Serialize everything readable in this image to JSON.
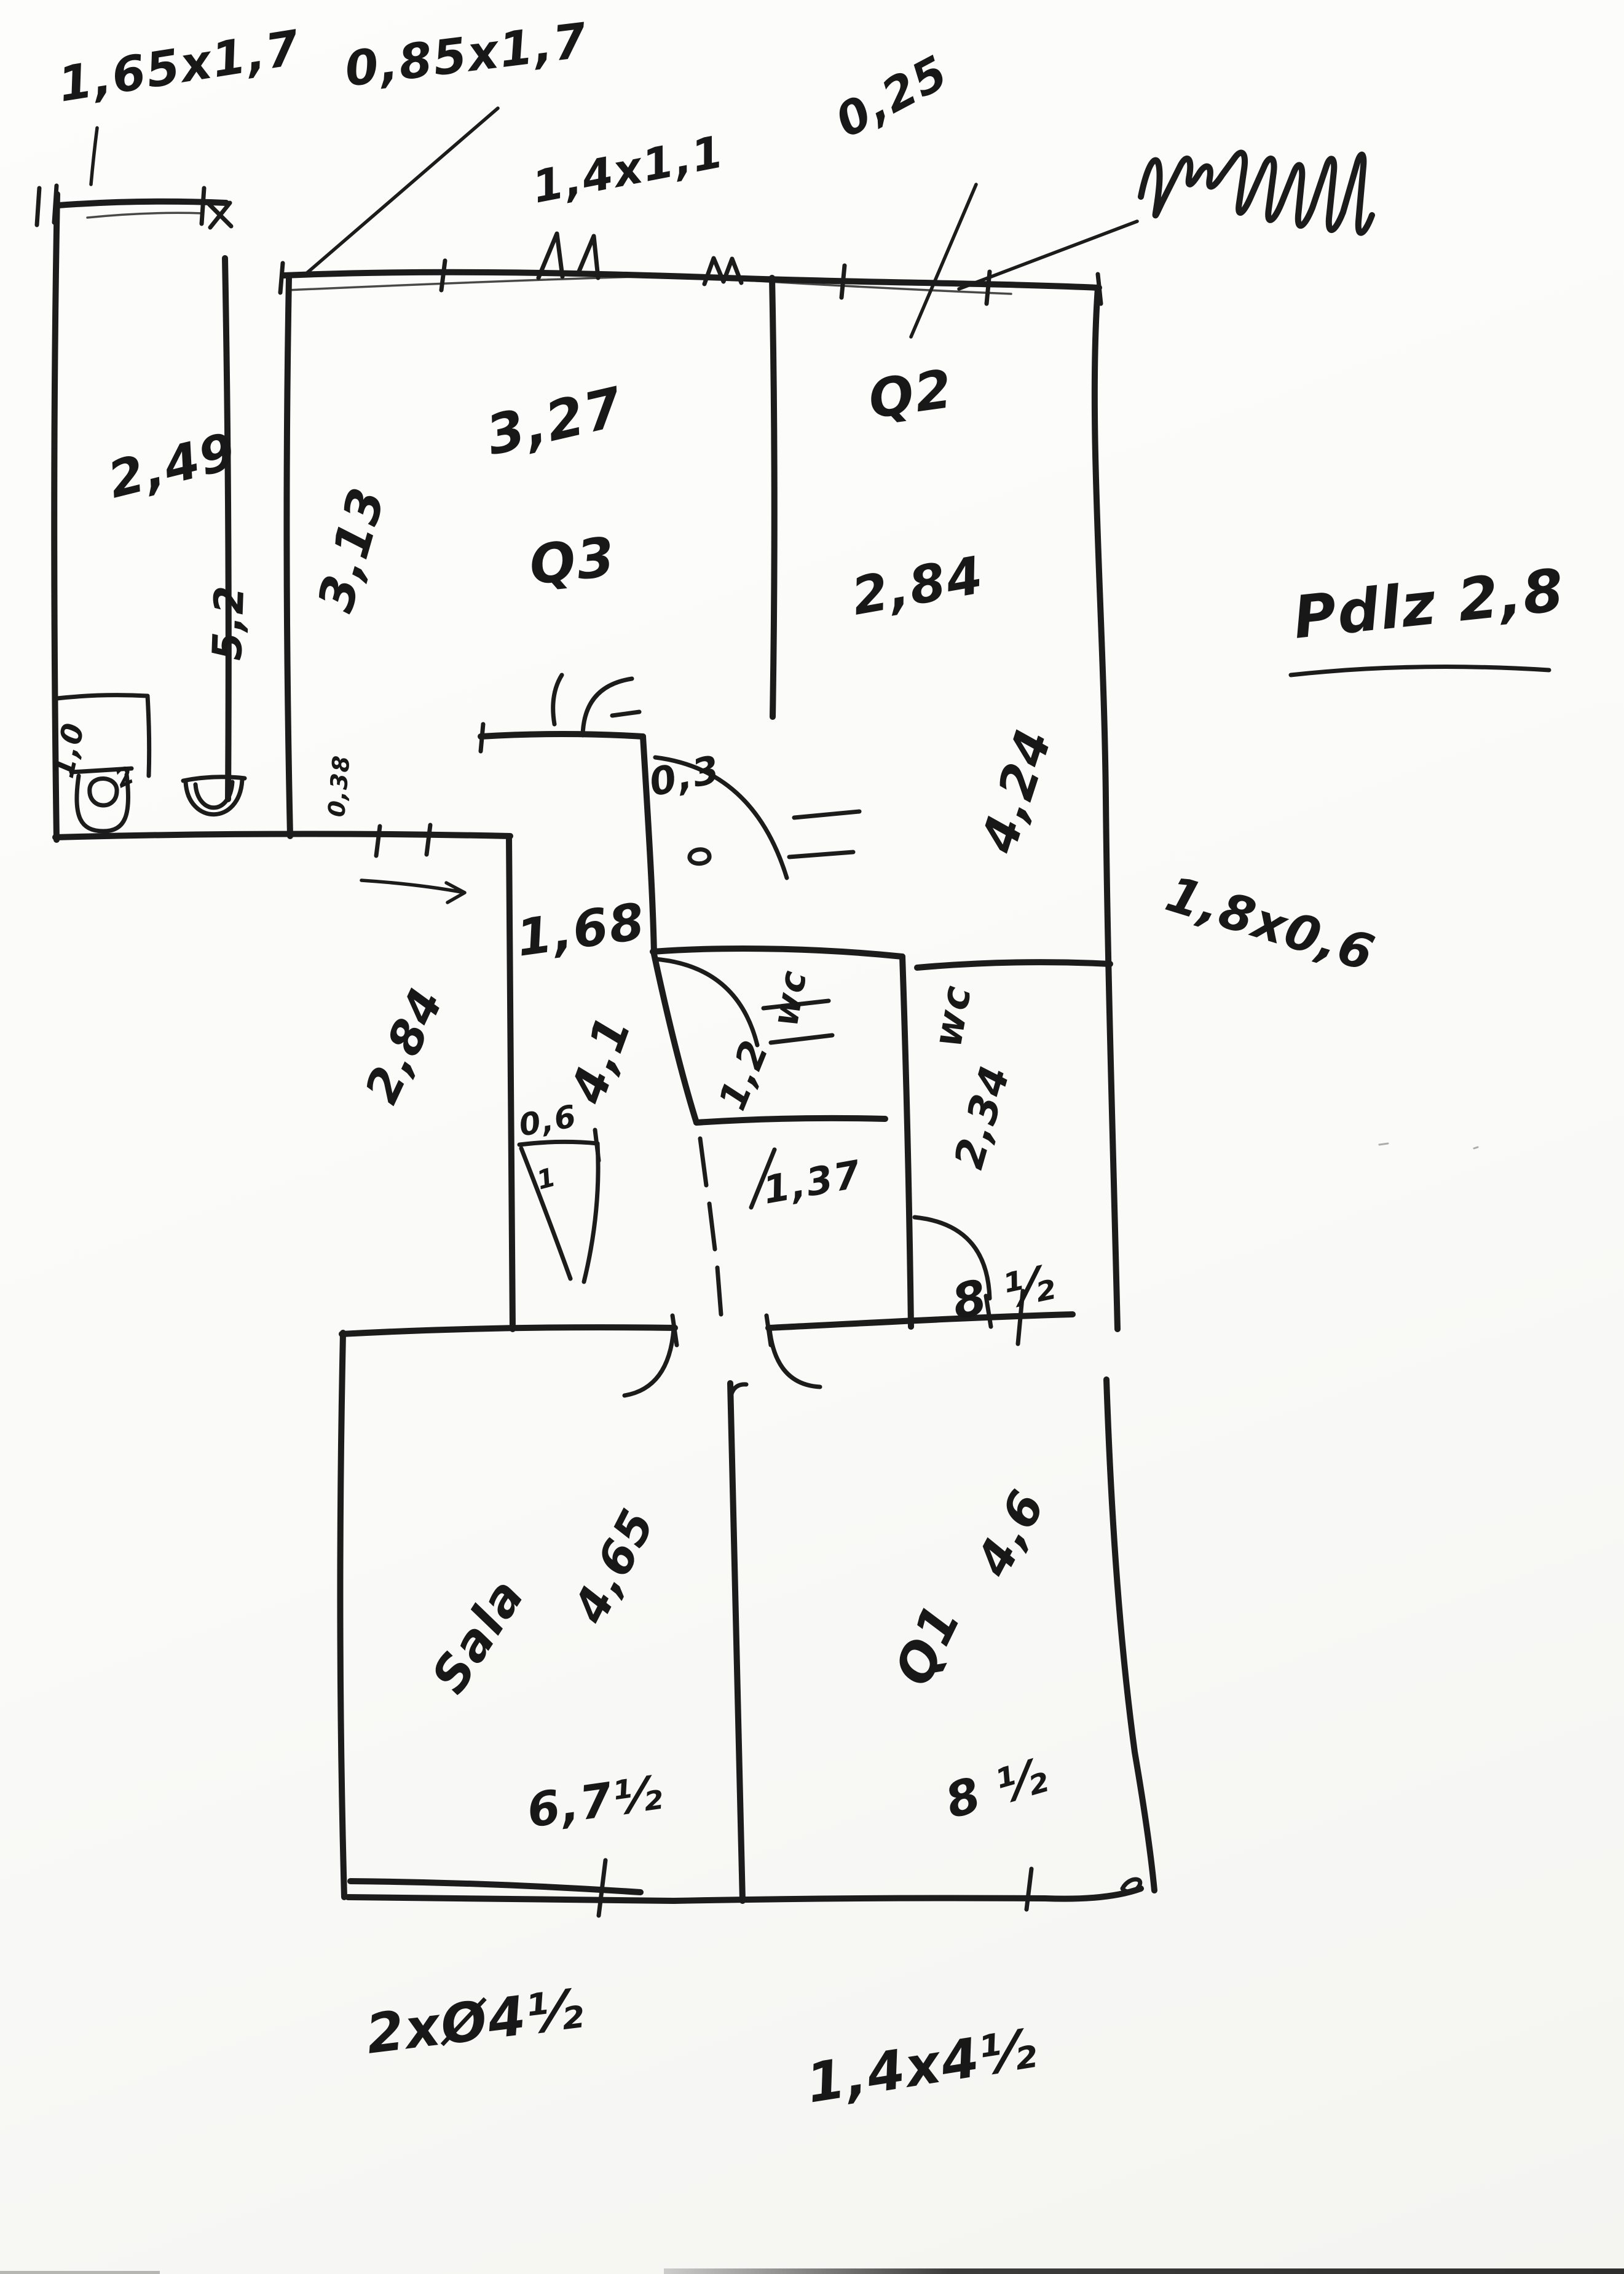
{
  "palette": {
    "paper": "#fbfbfa",
    "ink": "#1c1c1c"
  },
  "labels": {
    "dim_top_left": "1,65x1,7",
    "dim_top_door": "0,85x1,7",
    "dim_window": "1,4x1,1",
    "dim_wall": "0,25",
    "room1_width": "2,49",
    "room1_height": "5,2",
    "room3_left": "3,13",
    "room3_width": "3,27",
    "room3_name": "Q3",
    "room2_name": "Q2",
    "room2_width": "2,84",
    "room2_height": "4,24",
    "height_note": "Pdlz 2,8",
    "hall_offset": "0,3",
    "hall_width": "1,68",
    "hall_height": "4,1",
    "hall_left_dim": "2,84",
    "niche_dim": "0,6",
    "niche_inner": "1",
    "closet_dim": "1,0",
    "closet_sub": "2",
    "corridor_small": "0,38",
    "wc1_name": "wc",
    "wc1_width": "1,2",
    "wc1_length": "1,37",
    "wc2_name": "wc",
    "wc2_height": "2,34",
    "wc2_dim": "1,8x0,6",
    "wc_area": "8 ½",
    "sala_name": "Sala",
    "sala_height": "4,65",
    "sala_width": "6,7½",
    "q1_name": "Q1",
    "q1_height": "4,6",
    "q1_width": "8 ½",
    "note_bottom_left": "2xØ4½",
    "note_bottom_center": "1,4x4½"
  }
}
